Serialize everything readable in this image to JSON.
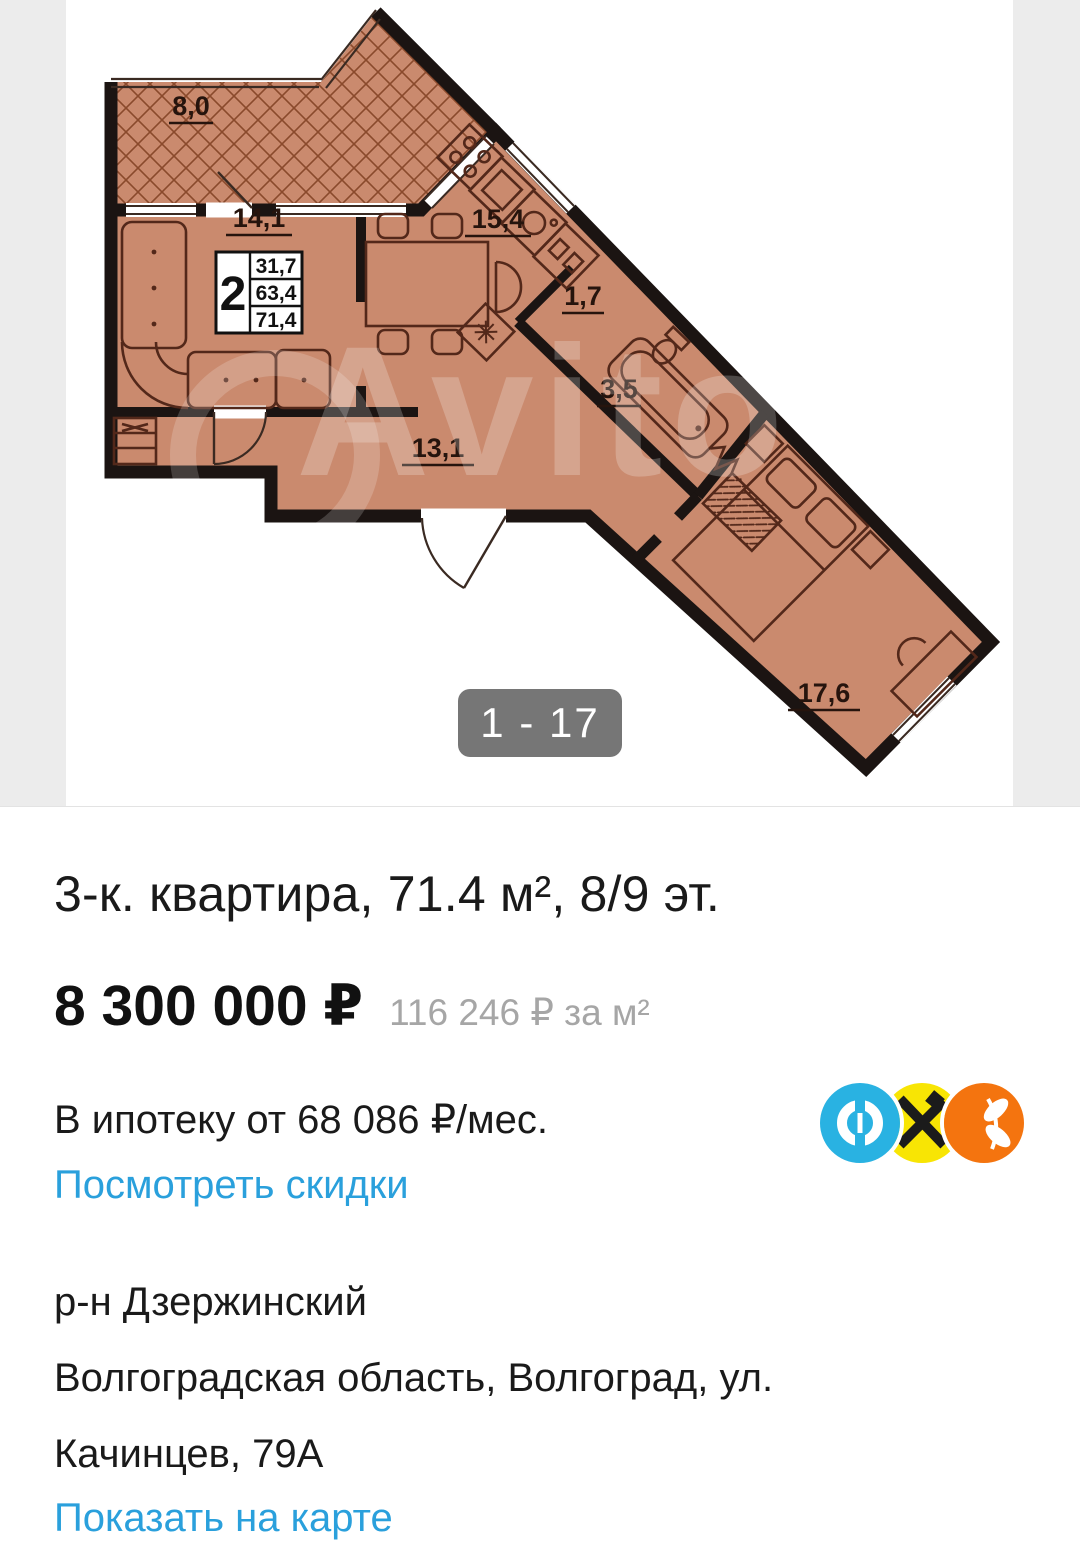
{
  "gallery": {
    "counter": "1 - 17",
    "watermark": "Avito"
  },
  "plan": {
    "labels": {
      "balcony": "8,0",
      "living": "14,1",
      "kitchen": "15,4",
      "corridor": "1,7",
      "bath": "3,5",
      "hall": "13,1",
      "bedroom": "17,6"
    },
    "info_box": {
      "rooms": "2",
      "living_area": "31,7",
      "usable_area": "63,4",
      "total_area": "71,4"
    }
  },
  "listing": {
    "title": "3-к. квартира, 71.4 м², 8/9 эт.",
    "price": "8 300 000 ₽",
    "price_per_m2": "116 246 ₽ за м²",
    "mortgage": "В ипотеку от 68 086 ₽/мес.",
    "discounts_link": "Посмотреть скидки"
  },
  "location": {
    "district": "р-н Дзержинский",
    "address_line1": "Волгоградская область, Волгоград, ул.",
    "address_line2": "Качинцев, 79А",
    "map_link": "Показать на карте"
  },
  "icons": {
    "bank_blue": "otkritie-bank-icon",
    "bank_yellow": "raiffeisen-bank-icon",
    "bank_orange": "orange-bank-icon"
  },
  "colors": {
    "plan_floor": "#ca8a6e",
    "plan_wall": "#1b1412",
    "accent_blue": "#2aa0dc",
    "badge_bg": "#767676",
    "logo_cyan": "#29b2e2",
    "logo_yellow": "#f8e504",
    "logo_orange": "#f4740f"
  }
}
